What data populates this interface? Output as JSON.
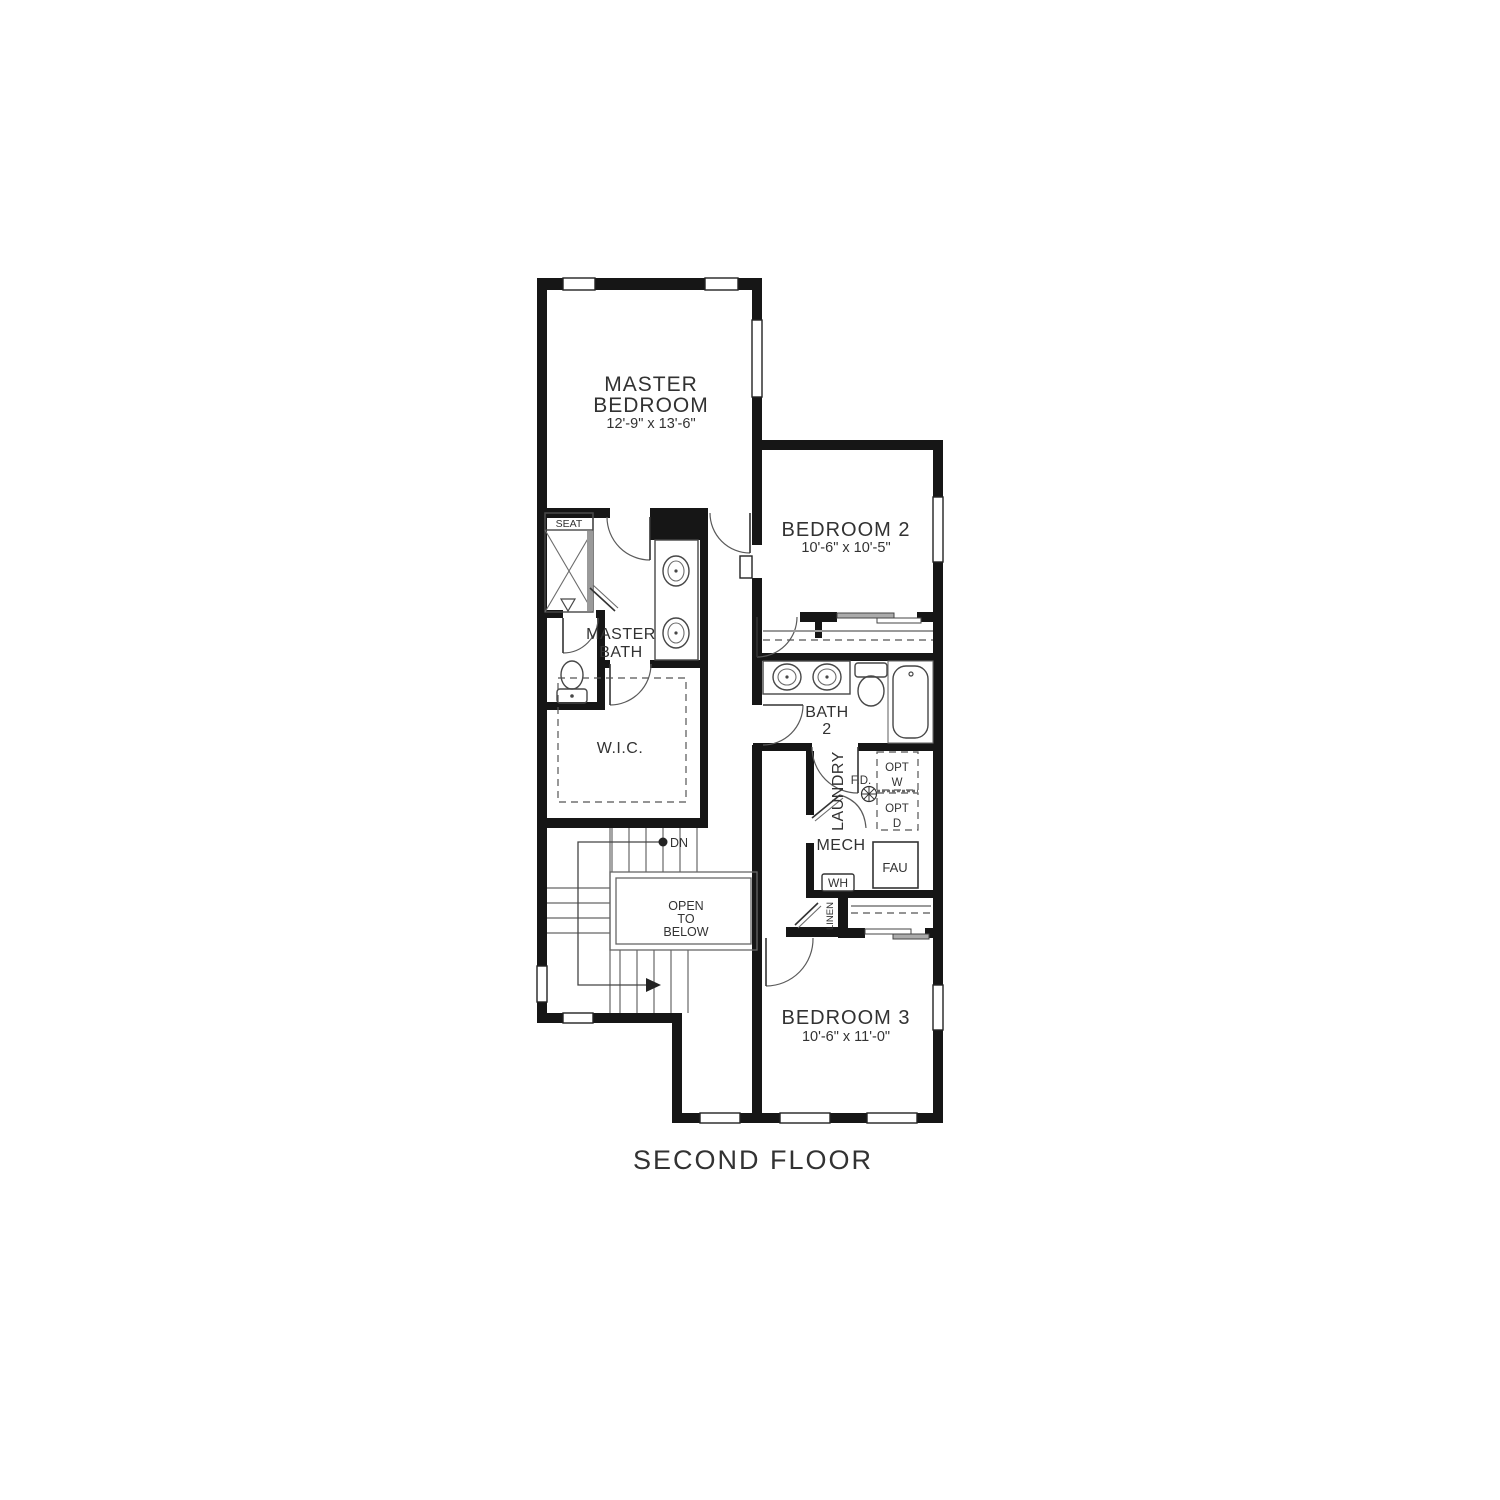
{
  "plan": {
    "title": "SECOND FLOOR",
    "rooms": {
      "master_bedroom_1": "MASTER",
      "master_bedroom_2": "BEDROOM",
      "master_bedroom_dims": "12'-9\" x 13'-6\"",
      "bedroom2_name": "BEDROOM 2",
      "bedroom2_dims": "10'-6\" x 10'-5\"",
      "bedroom3_name": "BEDROOM 3",
      "bedroom3_dims": "10'-6\" x 11'-0\"",
      "master_bath_1": "MASTER",
      "master_bath_2": "BATH",
      "bath2_1": "BATH",
      "bath2_2": "2",
      "wic": "W.I.C.",
      "laundry": "LAUNDRY",
      "mech": "MECH",
      "linen": "LINEN",
      "open_below_1": "OPEN",
      "open_below_2": "TO",
      "open_below_3": "BELOW"
    },
    "fixtures": {
      "seat": "SEAT",
      "dn": "DN",
      "fd": "F.D.",
      "wh": "WH",
      "fau": "FAU",
      "opt_w_1": "OPT",
      "opt_w_2": "W",
      "opt_d_1": "OPT",
      "opt_d_2": "D"
    },
    "colors": {
      "wall": "#161616",
      "line": "#4d4d4d",
      "text": "#323232",
      "bg": "#ffffff"
    }
  }
}
